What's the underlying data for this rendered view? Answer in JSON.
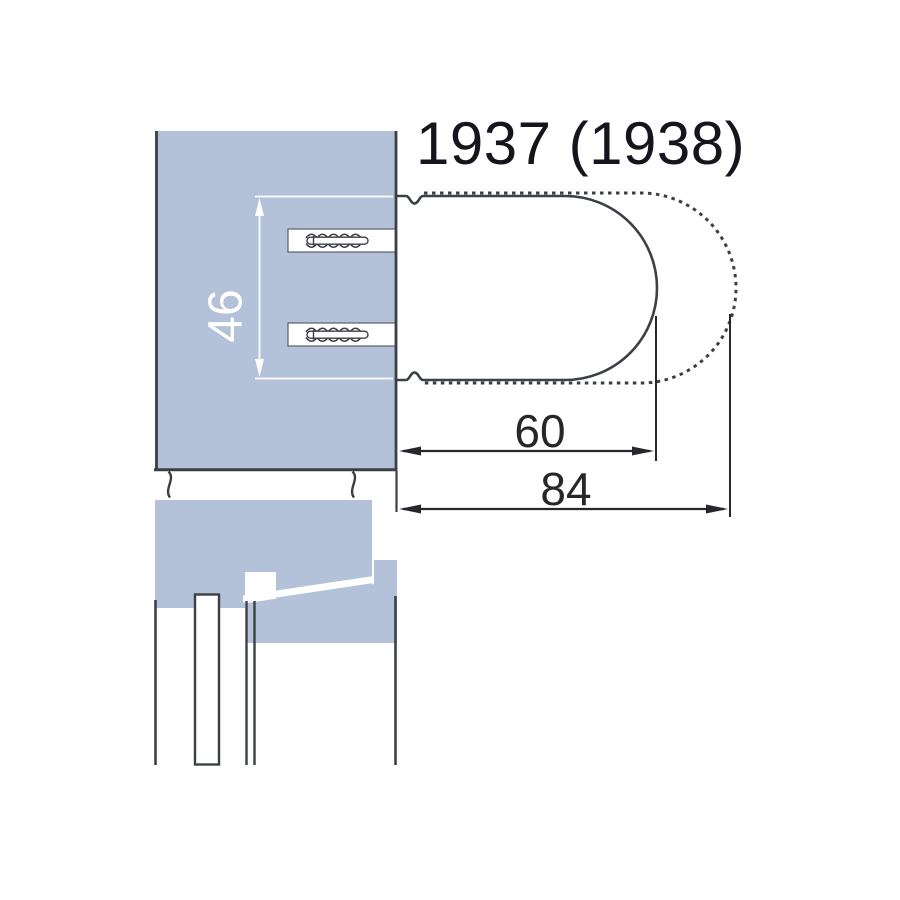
{
  "title": "1937 (1938)",
  "drawing": {
    "dim_height_label": "46",
    "dim_depth_solid_label": "60",
    "dim_depth_total_label": "84"
  },
  "colors": {
    "blue_fill": "#b3c1d9",
    "line_dark": "#3c4046",
    "dim_dark": "#26262b",
    "dim_white": "#ffffff",
    "title_text": "#15151d"
  }
}
